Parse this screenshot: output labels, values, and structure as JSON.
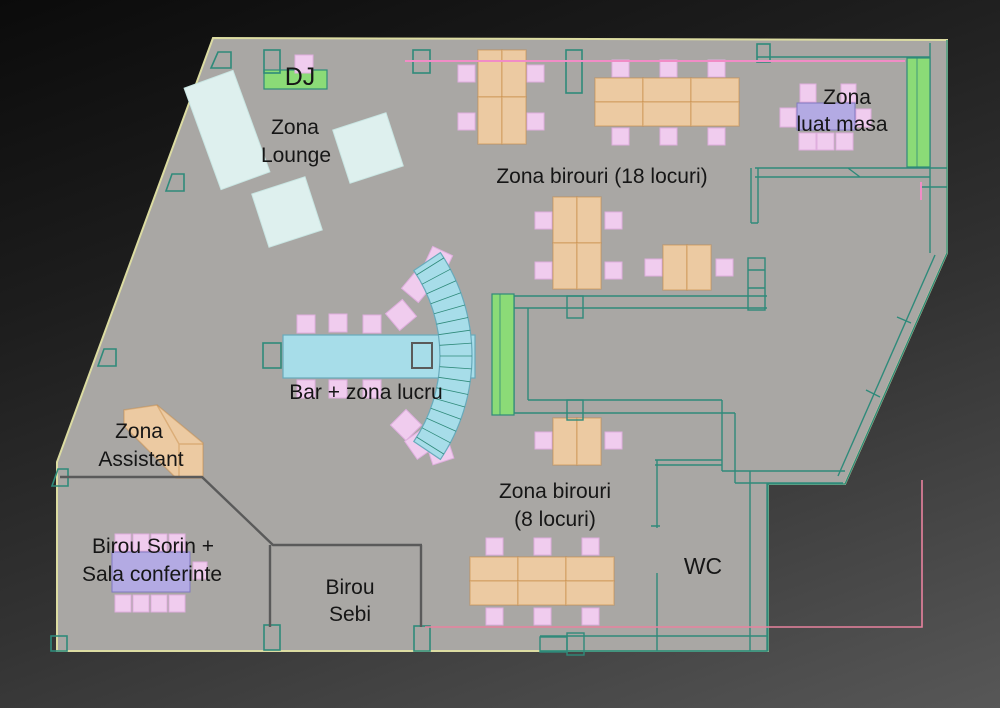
{
  "labels": {
    "dj": "DJ",
    "lounge_1": "Zona",
    "lounge_2": "Lounge",
    "birouri18": "Zona birouri (18 locuri)",
    "luat_masa_1": "Zona",
    "luat_masa_2": "luat masa",
    "bar": "Bar + zona lucru",
    "assistant_1": "Zona",
    "assistant_2": "Assistant",
    "sorin_1": "Birou Sorin +",
    "sorin_2": "Sala conferinte",
    "sebi_1": "Birou",
    "sebi_2": "Sebi",
    "birouri8_1": "Zona birouri",
    "birouri8_2": "(8 locuri)",
    "wc": "WC"
  },
  "colors": {
    "floor": "#a9a7a4",
    "edge_yellow": "#dcdca2",
    "wall_teal": "#2f8a7a",
    "partition_gray": "#5a5a5a",
    "desk_fill": "#eccaa2",
    "desk_border": "#c6884270",
    "chair_fill": "#f0ccee",
    "chair_border": "#dfaede",
    "table_purple": "#b3aae3",
    "table_border": "#8078c0",
    "green_fill": "#8bdb77",
    "couch_fill": "#def0ee",
    "couch_edge": "#c9e6e3",
    "bar_fill": "#a7dde9",
    "bar_edge": "#68aabb",
    "accent_pink": "#f18cc6",
    "accent_red": "#e8829e"
  }
}
